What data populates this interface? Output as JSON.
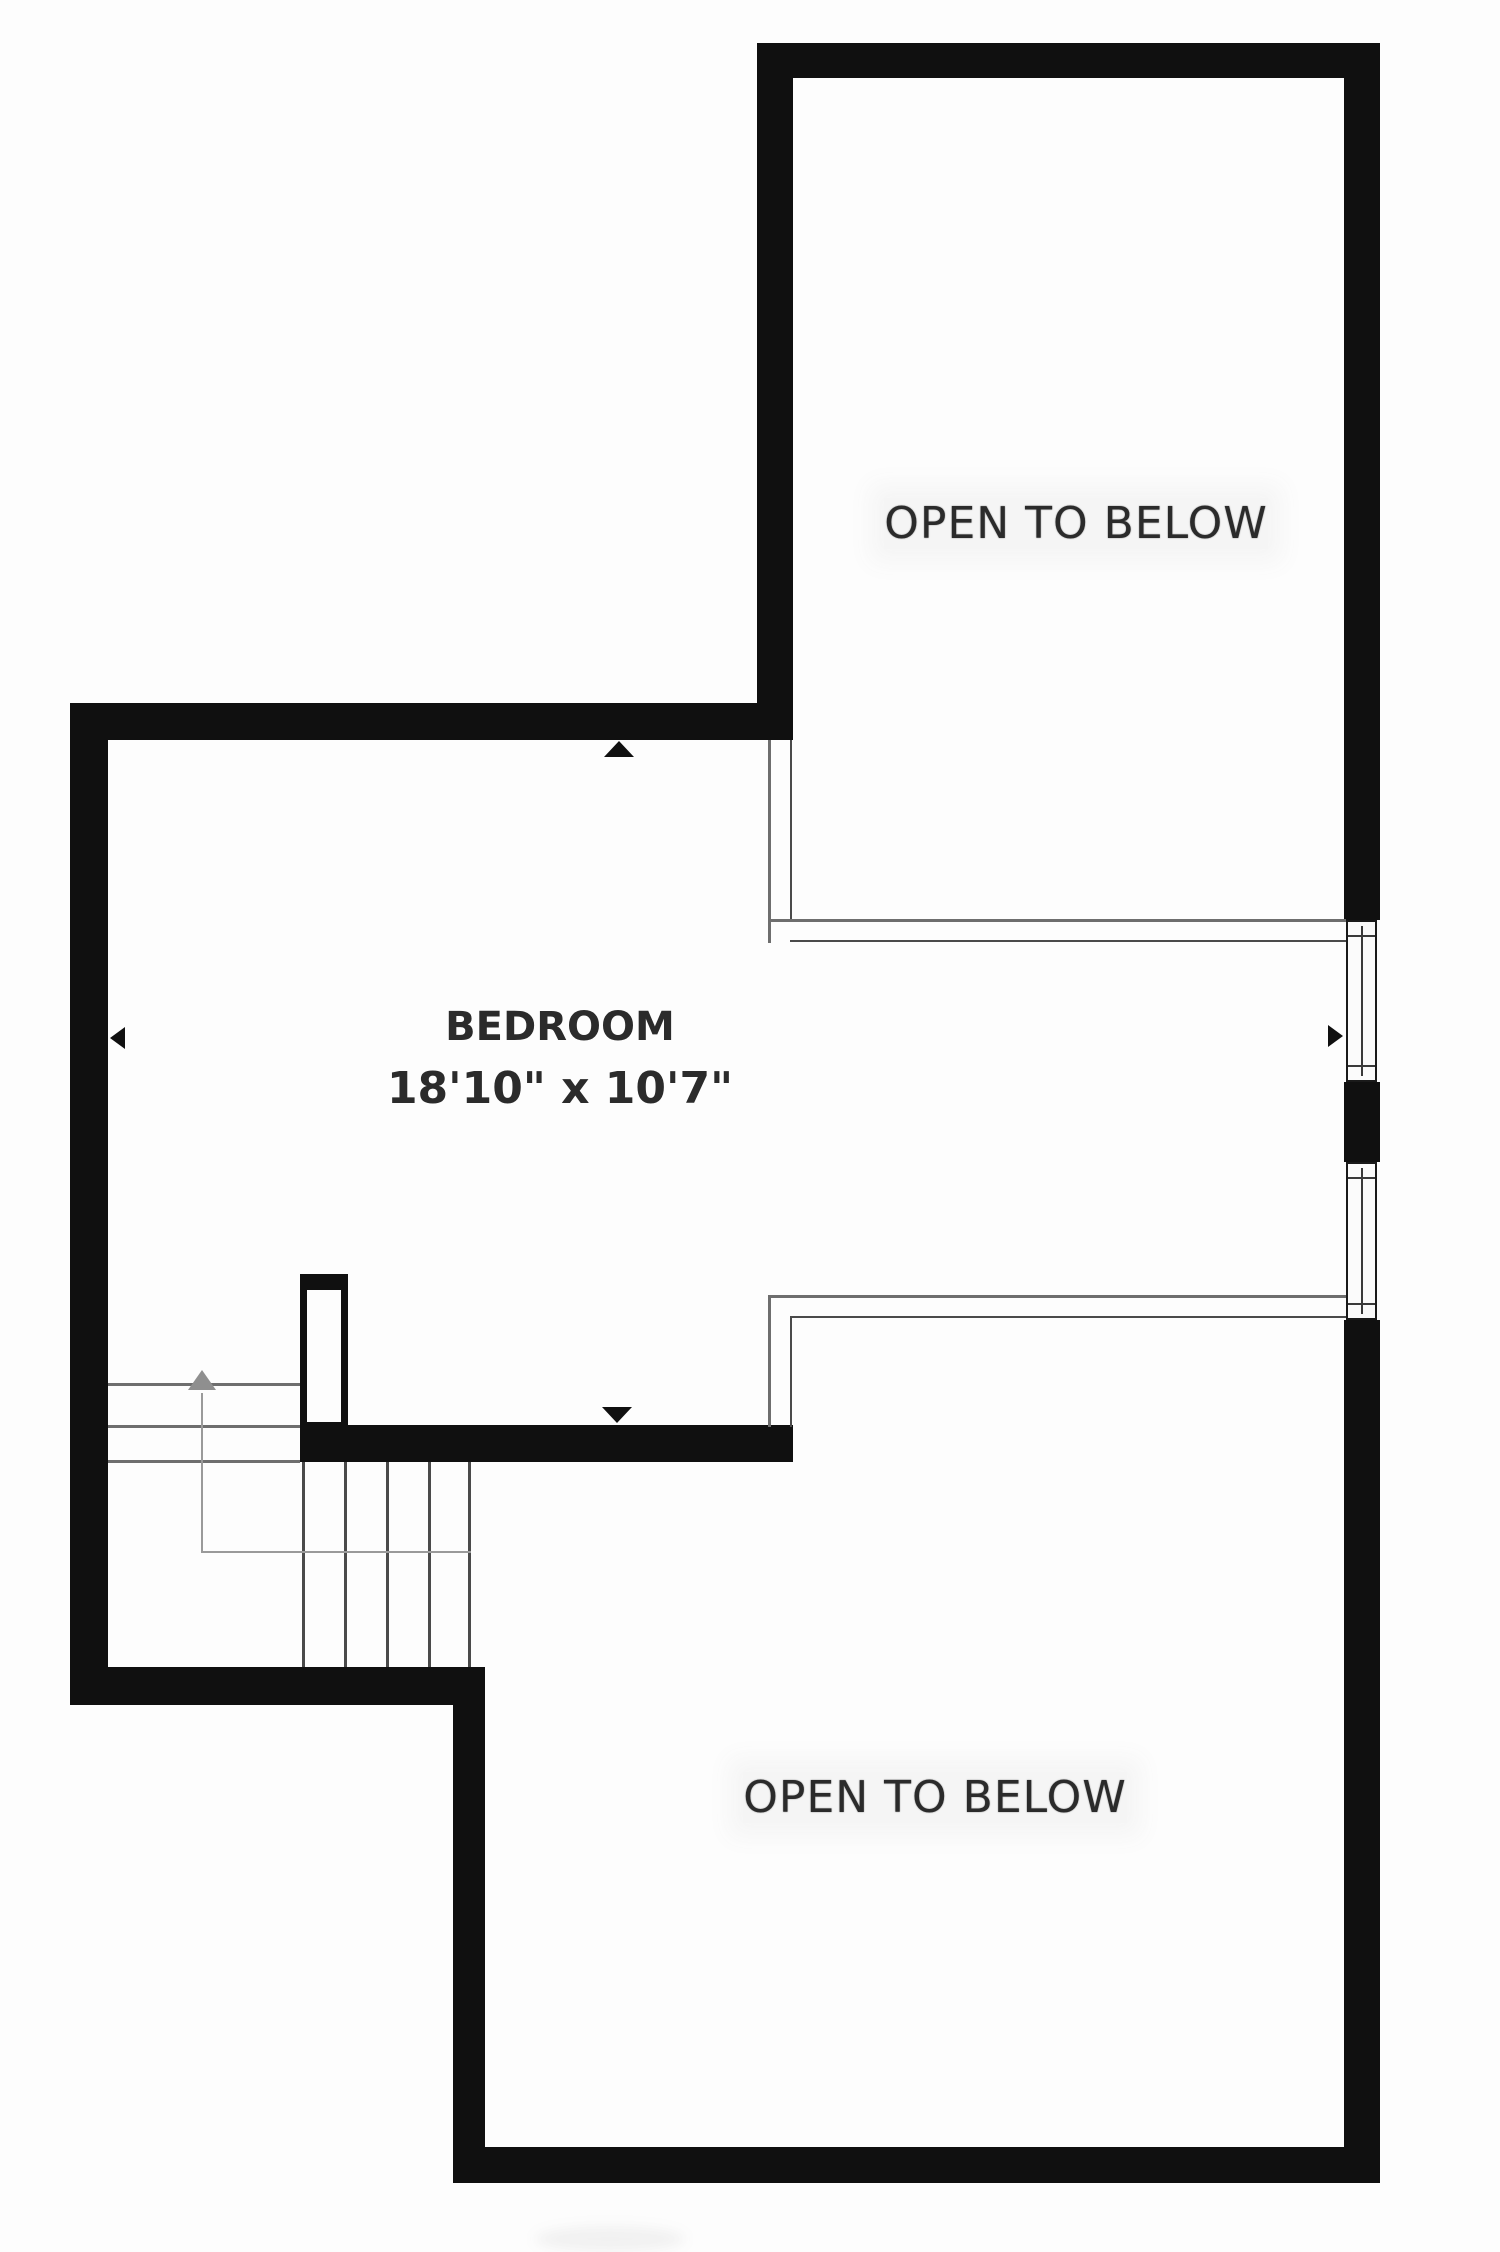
{
  "plan": {
    "type": "floor-plan",
    "rooms": {
      "upper_open": {
        "label": "OPEN TO BELOW"
      },
      "bedroom": {
        "label": "BEDROOM",
        "dimensions": "18'10\" x 10'7\""
      },
      "lower_open": {
        "label": "OPEN TO BELOW"
      }
    },
    "features": {
      "windows": [
        "right-wall-window-upper",
        "right-wall-window-lower"
      ],
      "stairs": "staircase-with-landing",
      "markers": [
        "wall-marker-up-icon",
        "wall-marker-down-icon",
        "dimension-arrow-left-icon",
        "dimension-arrow-right-icon",
        "stair-direction-up-icon"
      ]
    },
    "colors": {
      "wall": "#101010",
      "thin_line": "#4a4a4a",
      "guide_line": "#9a9a9a",
      "window_border": "#1a1a1a",
      "text": "#2b2b2b",
      "background": "#fdfdfd"
    }
  }
}
